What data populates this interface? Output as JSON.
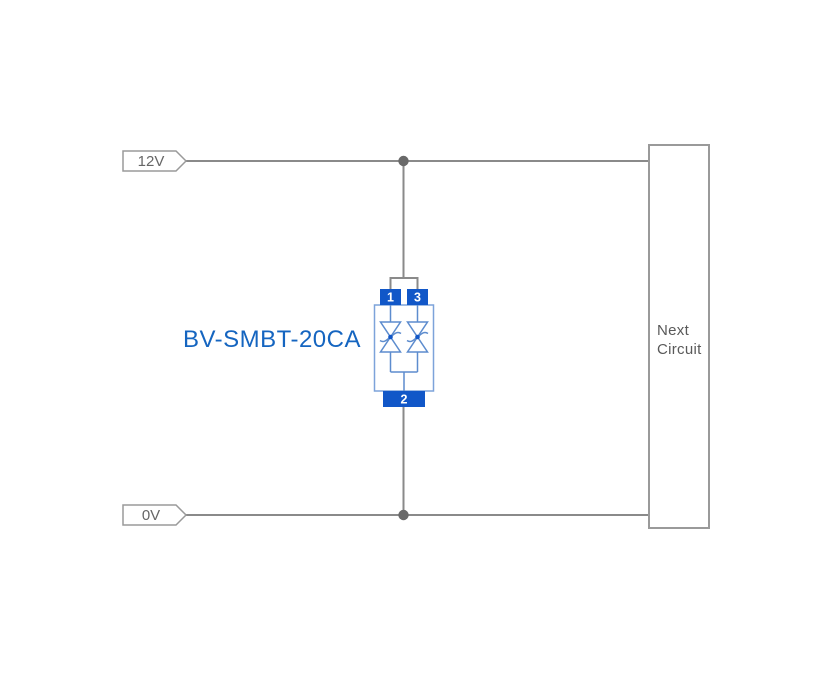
{
  "diagram": {
    "net_labels": {
      "top": "12V",
      "bottom": "0V"
    },
    "component": {
      "label": "BV-SMBT-20CA",
      "pins": {
        "p1": "1",
        "p2": "2",
        "p3": "3"
      }
    },
    "next_circuit": {
      "line1": "Next",
      "line2": "Circuit"
    },
    "colors": {
      "background": "#ffffff",
      "wire": "#8a8a8a",
      "junction_dot": "#696969",
      "tag_outline": "#9a9a9a",
      "tag_text": "#666666",
      "box_outline": "#9a9a9a",
      "box_text": "#595959",
      "pin_fill": "#1157c8",
      "pin_number": "#ffffff",
      "component_body_outline": "#7da3da",
      "diode_stroke": "#5d8cce",
      "component_label": "#1565c0"
    }
  }
}
